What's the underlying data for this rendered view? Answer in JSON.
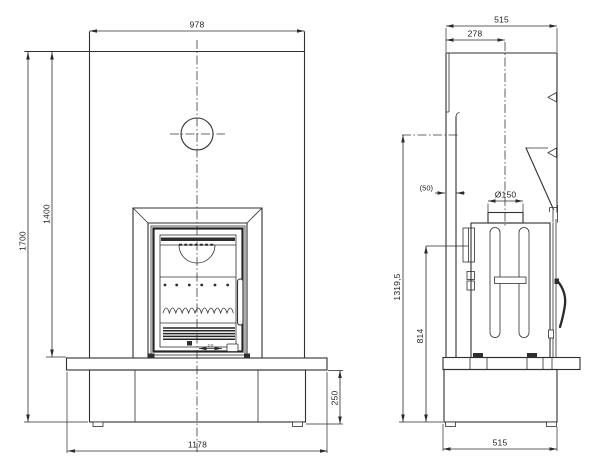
{
  "drawing": {
    "background": "#ffffff",
    "line_color": "#303030",
    "front_view": {
      "dims": {
        "width_top": "978",
        "height_total": "1700",
        "height_to_bench": "1400",
        "hearth_width": "1178",
        "plinth_height": "250",
        "door_micro_dim": "2-0"
      }
    },
    "side_view": {
      "dims": {
        "depth_top": "515",
        "flue_center_from_rear": "278",
        "rear_gap": "(50)",
        "flue_diameter": "Ø150",
        "height_connection": "1319,5",
        "height_rear_outlet": "814",
        "depth_base": "515"
      }
    }
  }
}
